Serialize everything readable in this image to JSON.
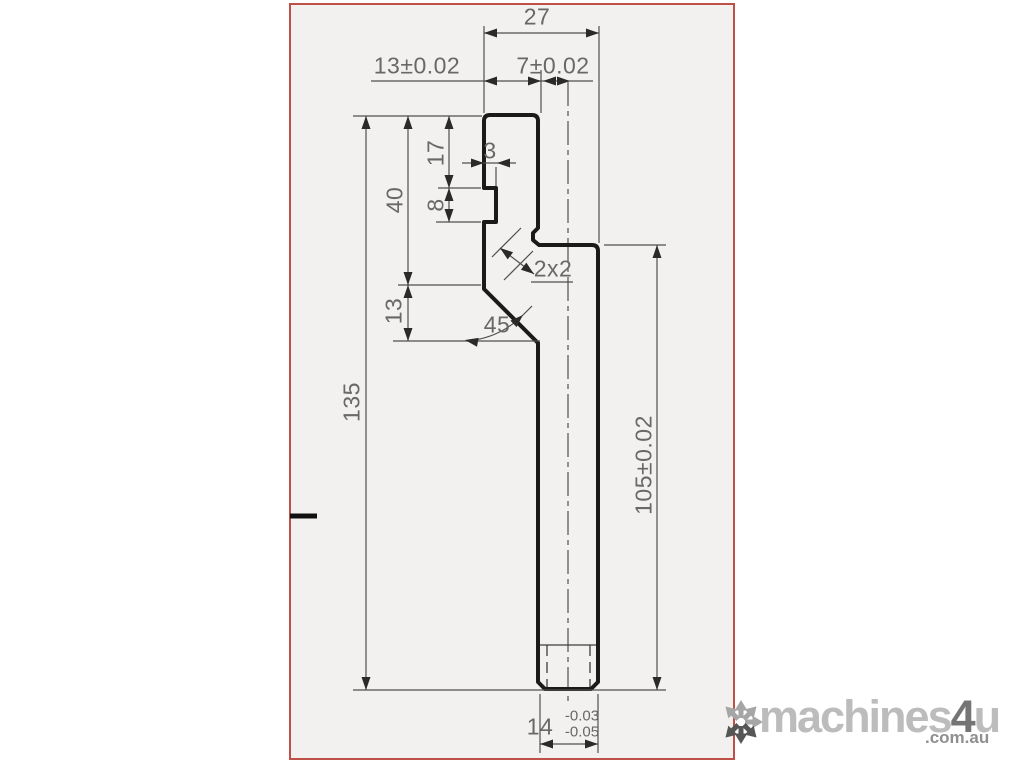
{
  "dims": {
    "overall_width_top": "27",
    "tab_width": "13±0.02",
    "tab_to_center": "7±0.02",
    "notch_depth": "3",
    "top_to_notch": "17",
    "notch_height": "8",
    "upper_section_height": "40",
    "chamfer_drop": "13",
    "overall_height": "135",
    "chamfer_angle": "45",
    "chamfer_size": "2x2",
    "shank_height": "105±0.02",
    "shank_width": "14",
    "shank_tol_upper": "-0.03",
    "shank_tol_lower": "-0.05"
  },
  "logo": {
    "brand_main": "machines",
    "brand_number": "4",
    "brand_u": "u",
    "suffix": ".com.au"
  },
  "colors": {
    "frame": "#bf5047",
    "drawing_background": "#f2f1ef",
    "outline": "#1a1a1a",
    "dimension_lines": "#4f4f4f",
    "dimension_text": "#686868"
  }
}
